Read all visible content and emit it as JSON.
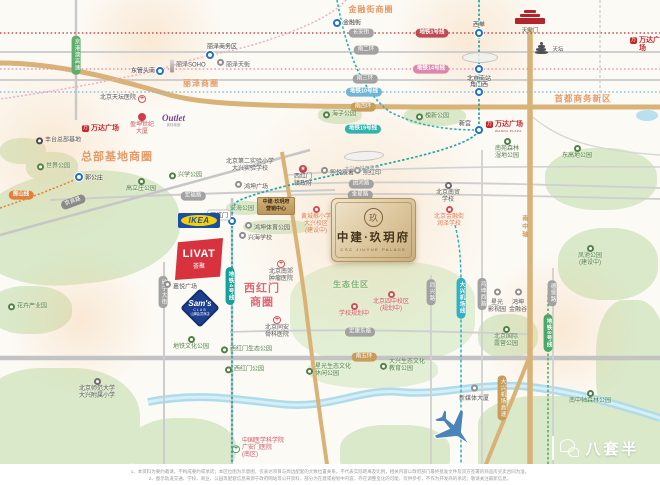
{
  "project": {
    "seal": "玖",
    "name": "中建·玖玥府",
    "name_en": "CSC JIUYUE PALACE",
    "sales_center_line1": "中建·玖玥府",
    "sales_center_line2": "营销中心"
  },
  "logos": {
    "ikea": "IKEA",
    "livat": "LIVAT",
    "livat_sub": "荟聚",
    "sams": "Sam's",
    "sams_club": "CLUB",
    "sams_sub": "山姆会员商店",
    "wanda": "万达广场",
    "wanda_en": "WANDA PLAZA",
    "wanda_icon_glyph": "万",
    "outlet": "Outlet",
    "outlet_sub": "奥特莱斯"
  },
  "landmarks": {
    "tiananmen": "天安门",
    "temple_of_heaven": "天坛"
  },
  "watermark": {
    "text": "八套半"
  },
  "disclaimer": {
    "line1": "1、本资料为要约邀请，不构成要约或承诺；本区位图为示意图，仅表达项目与周边配套的大致位置关系，不代表实际距离及比例，相关内容以政府部门最终批准文件及双方签署的商品房买卖合同为准。",
    "line2": "2、图示轨道交通、学校、商业、公园等配套信息来源于政府网站等公开资料，部分为在建或规划中内容，存在调整变化的可能，仅供参考，不作为开发商的承诺；敬请关注最新信息。"
  },
  "zones": [
    {
      "l": [
        "金融街商圈"
      ],
      "x": 371,
      "y": 10,
      "s": 8,
      "c": "orange"
    },
    {
      "l": [
        "丽泽商圈"
      ],
      "x": 201,
      "y": 84,
      "s": 8,
      "c": "orange"
    },
    {
      "l": [
        "总部基地商圈"
      ],
      "x": 117,
      "y": 158,
      "s": 11,
      "c": "orange"
    },
    {
      "l": [
        "首都商务新区"
      ],
      "x": 583,
      "y": 99,
      "s": 8.5,
      "c": "orange"
    },
    {
      "l": [
        "西红门",
        "商圈"
      ],
      "x": 262,
      "y": 296,
      "s": 11,
      "c": "red"
    },
    {
      "l": [
        "生态住区"
      ],
      "x": 351,
      "y": 285,
      "s": 8,
      "c": "green"
    }
  ],
  "road_badges": [
    {
      "t": "长安街",
      "x": 361,
      "y": 33
    },
    {
      "t": "南二环",
      "x": 366,
      "y": 50
    },
    {
      "t": "南三环",
      "x": 365,
      "y": 79
    },
    {
      "t": "南四环",
      "x": 363,
      "y": 107,
      "v": "gold"
    },
    {
      "t": "南五环",
      "x": 364,
      "y": 357,
      "v": "gold"
    },
    {
      "t": "宏福路",
      "x": 193,
      "y": 196
    },
    {
      "t": "团河路",
      "x": 361,
      "y": 184
    },
    {
      "t": "金星路",
      "x": 360,
      "y": 195
    },
    {
      "t": "宏康东路",
      "x": 360,
      "y": 332
    },
    {
      "t": "京良路",
      "x": 73,
      "y": 202,
      "r": -20,
      "v": "dark"
    },
    {
      "t": "欣宁大街",
      "x": 163,
      "y": 292,
      "vert": true
    },
    {
      "t": "同兴路",
      "x": 431,
      "y": 292,
      "vert": true
    },
    {
      "t": "鸿坤西路",
      "x": 482,
      "y": 294,
      "vert": true
    },
    {
      "t": "德贤路",
      "x": 552,
      "y": 293,
      "vert": true
    },
    {
      "t": "南中轴",
      "x": 523,
      "y": 227,
      "vert": true,
      "v": "goldtext"
    },
    {
      "t": "大兴机场高速",
      "x": 502,
      "y": 398,
      "vert": true,
      "v": "gold"
    },
    {
      "t": "京港澳高速",
      "x": 76,
      "y": 55,
      "vert": true,
      "v": "green"
    }
  ],
  "metro_badges": [
    {
      "t": "地铁1号线",
      "x": 432,
      "y": 33,
      "c": "#c04a52"
    },
    {
      "t": "地铁14号线",
      "x": 431,
      "y": 69,
      "c": "#dd86ae"
    },
    {
      "t": "地铁10号线",
      "x": 364,
      "y": 92,
      "c": "#6fb5d8"
    },
    {
      "t": "地铁19号线",
      "x": 363,
      "y": 129,
      "c": "#2fb3ab"
    },
    {
      "t": "地铁4号线",
      "x": 230,
      "y": 286,
      "c": "#17a099",
      "vert": true
    },
    {
      "t": "大兴机场线",
      "x": 461,
      "y": 298,
      "c": "#2fb0c4",
      "vert": true
    },
    {
      "t": "地铁8号线",
      "x": 548,
      "y": 333,
      "c": "#4aa968",
      "vert": true
    },
    {
      "t": "房山线",
      "x": 21,
      "y": 195,
      "c": "#e0803c"
    }
  ],
  "stations": [
    {
      "t": "金融街",
      "cx": 337,
      "cy": 23,
      "lx": 352,
      "ly": 22
    },
    {
      "t": "西单",
      "cx": 479,
      "cy": 33,
      "lx": 479,
      "ly": 24
    },
    {
      "t": "北京南站",
      "cx": 479,
      "cy": 69,
      "lx": 479,
      "ly": 78
    },
    {
      "t": "角门西",
      "cx": 479,
      "cy": 92,
      "lx": 479,
      "ly": 84
    },
    {
      "t": "新宫",
      "cx": 479,
      "cy": 130,
      "lx": 465,
      "ly": 123
    },
    {
      "t": "丽泽商务区",
      "cx": 210,
      "cy": 55,
      "lx": 222,
      "ly": 46
    },
    {
      "t": "东管头南",
      "cx": 160,
      "cy": 71,
      "lx": 143,
      "ly": 70
    },
    {
      "t": "郭公庄",
      "cx": 79,
      "cy": 177,
      "lx": 94,
      "ly": 177
    },
    {
      "t": "西红门",
      "cx": 232,
      "cy": 221,
      "lx": 219,
      "ly": 215,
      "pill": true
    }
  ],
  "pois": [
    {
      "i": "tower",
      "l": [
        "丽泽SOHO"
      ],
      "x": 170,
      "y": 66,
      "m": "h",
      "c": "dark"
    },
    {
      "i": "poi",
      "l": [
        "丽泽天街"
      ],
      "x": 217,
      "y": 66,
      "m": "h",
      "c": "dark"
    },
    {
      "i": "hospital",
      "l": [
        "北京天坛医院"
      ],
      "x": 100,
      "y": 99,
      "m": "hr",
      "c": "dark"
    },
    {
      "i": "pin",
      "l": [
        "盈坤世纪",
        "大厦"
      ],
      "x": 142,
      "y": 113,
      "m": "v",
      "c": "red"
    },
    {
      "i": "poi-dark",
      "l": [
        "丰台总部基地"
      ],
      "x": 36,
      "y": 141,
      "m": "h",
      "c": "dark"
    },
    {
      "i": "park",
      "l": [
        "世界公园"
      ],
      "x": 37,
      "y": 167,
      "m": "h",
      "c": "green"
    },
    {
      "i": "park",
      "l": [
        "高立庄公园"
      ],
      "x": 141,
      "y": 178,
      "m": "v",
      "c": "green"
    },
    {
      "i": "park",
      "l": [
        "兴学公园"
      ],
      "x": 169,
      "y": 176,
      "m": "h",
      "c": "green"
    },
    {
      "l": [
        "北京第二实验小学",
        "大兴实验学校"
      ],
      "x": 250,
      "y": 159,
      "m": "v",
      "c": "dark"
    },
    {
      "i": "poi",
      "l": [
        "鸿坤广场"
      ],
      "x": 235,
      "y": 188,
      "m": "h",
      "c": "dark"
    },
    {
      "i": "poi",
      "l": [
        "熙悦宸著"
      ],
      "x": 321,
      "y": 174,
      "m": "h",
      "c": "dark"
    },
    {
      "i": "poi",
      "l": [
        "熙红印"
      ],
      "x": 354,
      "y": 174,
      "m": "h",
      "c": "dark"
    },
    {
      "l": [
        "大兴大悦春风里"
      ],
      "x": 362,
      "y": 166,
      "m": "v",
      "c": "gray"
    },
    {
      "i": "govt",
      "l": [
        "西红门",
        "镇政府"
      ],
      "x": 303,
      "y": 165,
      "m": "v",
      "c": "dark"
    },
    {
      "i": "school",
      "l": [
        "北京南贸",
        "学校"
      ],
      "x": 448,
      "y": 182,
      "m": "v",
      "c": "dark"
    },
    {
      "i": "planned",
      "l": [
        "北京金融街",
        "润泽学校"
      ],
      "x": 449,
      "y": 206,
      "m": "v",
      "c": "orange"
    },
    {
      "i": "planned",
      "l": [
        "黄城根小学",
        "大兴校区",
        "(建设中)"
      ],
      "x": 316,
      "y": 206,
      "m": "v",
      "c": "orange"
    },
    {
      "i": "hospital",
      "l": [
        "北京南郊",
        "肿瘤医院"
      ],
      "x": 281,
      "y": 260,
      "m": "v",
      "c": "dark"
    },
    {
      "i": "hospital",
      "l": [
        "北京同安",
        "骨科医院"
      ],
      "x": 277,
      "y": 316,
      "m": "v",
      "c": "dark"
    },
    {
      "i": "planned",
      "l": [
        "学校规划中"
      ],
      "x": 354,
      "y": 303,
      "m": "v",
      "c": "red"
    },
    {
      "i": "planned",
      "l": [
        "北京四中校区",
        "(规划中)"
      ],
      "x": 391,
      "y": 291,
      "m": "v",
      "c": "red"
    },
    {
      "i": "park",
      "l": [
        "西红门生态公园"
      ],
      "x": 221,
      "y": 350,
      "m": "h",
      "c": "green"
    },
    {
      "i": "park",
      "l": [
        "地铁文化公园"
      ],
      "x": 191,
      "y": 336,
      "m": "v",
      "c": "green"
    },
    {
      "i": "park",
      "l": [
        "西红门公园"
      ],
      "x": 225,
      "y": 370,
      "m": "h",
      "c": "green"
    },
    {
      "i": "school",
      "l": [
        "北京师范大学",
        "大兴附属小学"
      ],
      "x": 97,
      "y": 378,
      "m": "v",
      "c": "dark"
    },
    {
      "i": "park",
      "l": [
        "星光生态文化",
        "休闲公园"
      ],
      "x": 306,
      "y": 371,
      "m": "h",
      "c": "green"
    },
    {
      "i": "park",
      "l": [
        "大兴生态文化",
        "教育公园"
      ],
      "x": 380,
      "y": 366,
      "m": "h",
      "c": "green"
    },
    {
      "i": "park",
      "l": [
        "北京国际",
        "露营公园"
      ],
      "x": 506,
      "y": 326,
      "m": "v",
      "c": "green"
    },
    {
      "i": "poi",
      "l": [
        "星光",
        "影视园"
      ],
      "x": 497,
      "y": 292,
      "m": "v",
      "c": "dark"
    },
    {
      "i": "poi",
      "l": [
        "鸿坤",
        "金融谷"
      ],
      "x": 518,
      "y": 292,
      "m": "v",
      "c": "dark"
    },
    {
      "i": "poi",
      "l": [
        "新媒体大厦"
      ],
      "x": 474,
      "y": 388,
      "m": "v",
      "c": "dark"
    },
    {
      "i": "hgreen",
      "l": [
        "中国医学科学院",
        "广安门医院",
        "(南区)"
      ],
      "x": 232,
      "y": 449,
      "m": "h",
      "c": "red"
    },
    {
      "i": "park",
      "l": [
        "凤池公园",
        "(建设中)"
      ],
      "x": 590,
      "y": 245,
      "m": "v",
      "c": "green"
    },
    {
      "i": "park",
      "l": [
        "东高地公园"
      ],
      "x": 577,
      "y": 145,
      "m": "v",
      "c": "green"
    },
    {
      "i": "park",
      "l": [
        "南苑森林",
        "湿地公园"
      ],
      "x": 507,
      "y": 138,
      "m": "v",
      "c": "green"
    },
    {
      "i": "park",
      "l": [
        "槐新公园"
      ],
      "x": 416,
      "y": 117,
      "m": "h",
      "c": "green"
    },
    {
      "i": "park",
      "l": [
        "海子公园"
      ],
      "x": 323,
      "y": 115,
      "m": "h",
      "c": "green"
    },
    {
      "i": "park",
      "l": [
        "南中轴森林公园"
      ],
      "x": 590,
      "y": 390,
      "m": "v",
      "c": "green"
    },
    {
      "i": "poi",
      "l": [
        "嘉悦广场"
      ],
      "x": 164,
      "y": 288,
      "m": "h",
      "c": "dark"
    },
    {
      "i": "park",
      "l": [
        "花卉产业园"
      ],
      "x": 8,
      "y": 307,
      "m": "h",
      "c": "green"
    },
    {
      "i": "poi",
      "l": [
        "兴海学校"
      ],
      "x": 239,
      "y": 239,
      "m": "h",
      "c": "dark"
    },
    {
      "i": "poi",
      "l": [
        "鸿坤体育公园"
      ],
      "x": 245,
      "y": 229,
      "m": "h",
      "c": "dark"
    },
    {
      "l": [
        "兴海公园"
      ],
      "x": 242,
      "y": 206,
      "m": "v",
      "c": "green"
    }
  ]
}
